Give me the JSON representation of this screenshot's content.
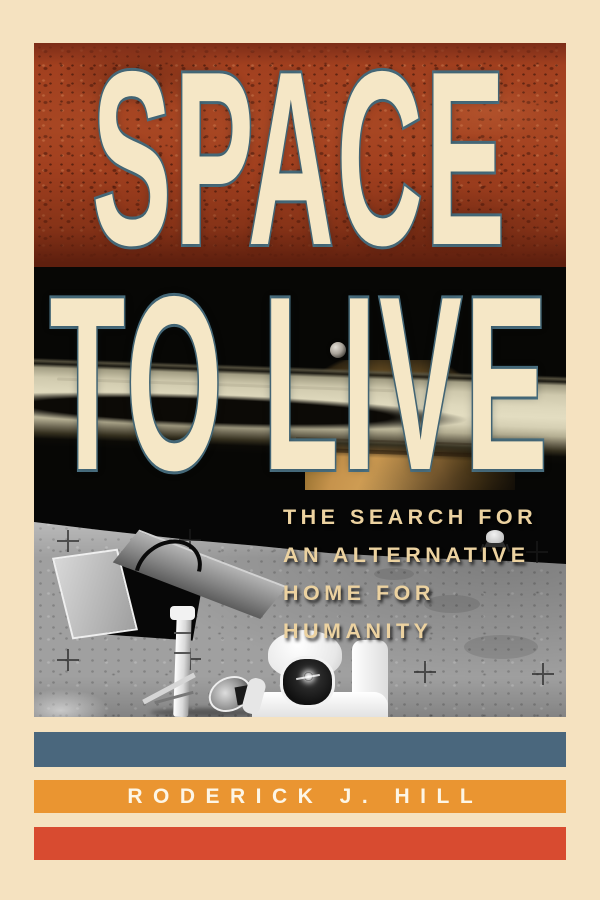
{
  "cover": {
    "photos": {
      "top": "mars-surface-photo",
      "middle": "saturn-rings-space-photo",
      "bottom": "moon-astronaut-lander-photo"
    },
    "title": {
      "line1": "SPACE",
      "line2": "TO LIVE"
    },
    "subtitle_lines": [
      "THE SEARCH FOR",
      "AN ALTERNATIVE",
      "HOME FOR",
      "HUMANITY"
    ],
    "author": "RODERICK J. HILL",
    "colors": {
      "background_cream": "#f5e2c0",
      "title_fill": "#f5e7c6",
      "title_outline": "#4d7384",
      "subtitle_text": "#ecd2a0",
      "author_text": "#fdf6e6",
      "stripe_blue": "#4a677d",
      "stripe_orange": "#ea9531",
      "stripe_red": "#d84b30",
      "mars_red": "#a2401f",
      "space_black": "#070705",
      "ring_cream": "#ded8bc",
      "planet_tan": "#d9a85c",
      "moon_gray": "#a0a0a0"
    }
  }
}
